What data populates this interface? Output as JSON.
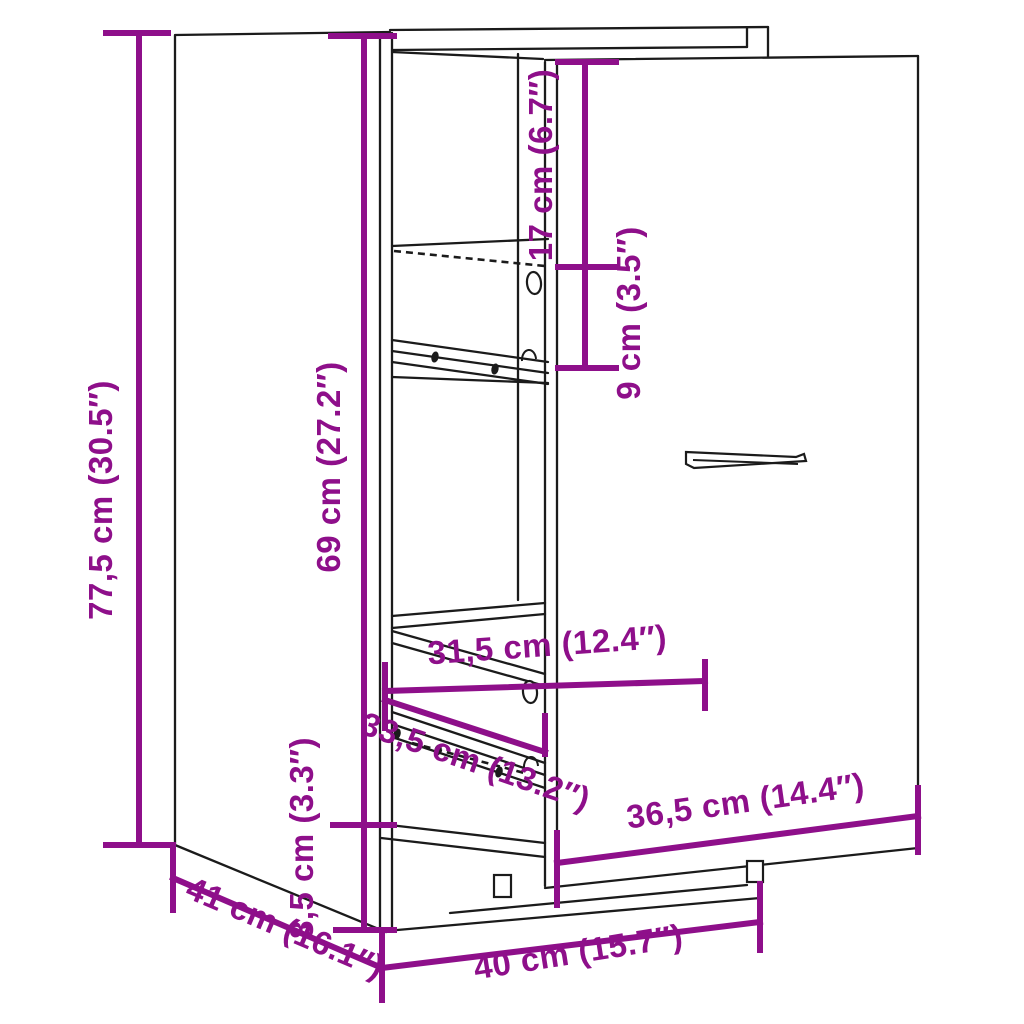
{
  "diagram_title": "Apothecary cabinet dimension drawing",
  "colors": {
    "accent": "#8E0F8A",
    "line": "#1b1b1b",
    "background": "#ffffff"
  },
  "dimensions": {
    "total_height": "77,5 cm (30.5″)",
    "interior_height": "69 cm (27.2″)",
    "top_clearance": "17 cm (6.7″)",
    "shelf_spacing": "9 cm (3.5″)",
    "base_height": "8,5 cm (3.3″)",
    "interior_width": "31,5 cm (12.4″)",
    "drawer_width": "33,5 cm (13.2″)",
    "door_width": "36,5 cm (14.4″)",
    "depth": "41 cm (16.1″)",
    "width": "40 cm (15.7″)"
  }
}
